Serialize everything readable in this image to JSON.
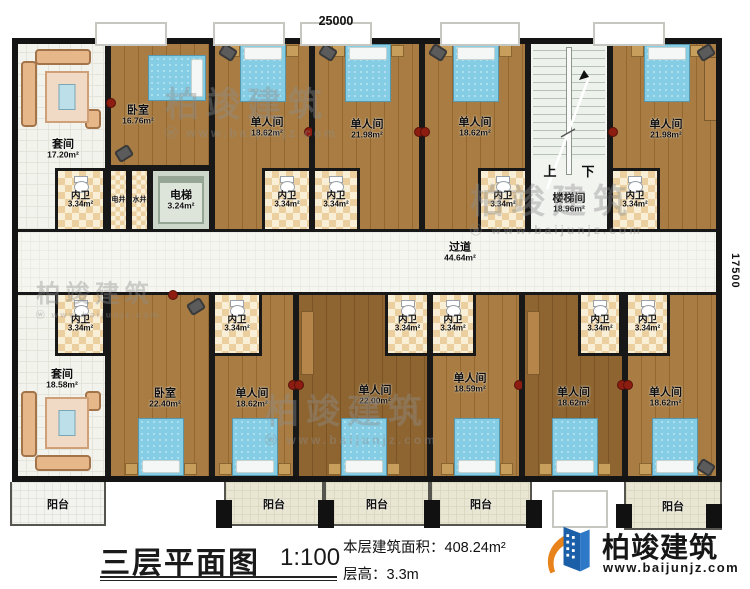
{
  "dimensions": {
    "top": "25000",
    "right": "17500"
  },
  "title_block": {
    "plan_title": "三层平面图",
    "scale": "1:100",
    "area_label": "本层建筑面积：",
    "area_value": "408.24m²",
    "floor_height_label": "层高：",
    "floor_height_value": "3.3m"
  },
  "logo": {
    "name": "柏竣建筑",
    "url": "www.baijunjz.com"
  },
  "watermark": {
    "text": "柏竣建筑",
    "url": "www.baijunjz.com"
  },
  "plan": {
    "stair": {
      "up": "上",
      "down": "下"
    },
    "rooms": [
      {
        "id": "suite-up",
        "name": "套间",
        "area": "17.20m²",
        "x": 12,
        "y": 38,
        "w": 96,
        "h": 194,
        "type": "tile",
        "lx": 3,
        "ly": 14,
        "furn": [
          "sofa-n"
        ]
      },
      {
        "id": "bedroom-up",
        "name": "卧室",
        "area": "16.76m²",
        "x": 108,
        "y": 38,
        "w": 104,
        "h": 130,
        "type": "wood",
        "lx": -22,
        "ly": 12,
        "furn": [
          "bed-e",
          "dot-w",
          "chair-sw"
        ]
      },
      {
        "id": "single-u1",
        "name": "单人间",
        "area": "18.62m²",
        "x": 212,
        "y": 38,
        "w": 100,
        "h": 194,
        "type": "wood",
        "lx": 5,
        "ly": -8,
        "furn": [
          "bed-n",
          "chair-nw",
          "dot-e"
        ]
      },
      {
        "id": "single-u2",
        "name": "单人间",
        "area": "21.98m²",
        "x": 312,
        "y": 38,
        "w": 110,
        "h": 194,
        "type": "wood",
        "lx": 0,
        "ly": -6,
        "furn": [
          "bed-n",
          "chair-nw",
          "dot-e"
        ]
      },
      {
        "id": "single-u3",
        "name": "单人间",
        "area": "18.62m²",
        "x": 422,
        "y": 38,
        "w": 106,
        "h": 194,
        "type": "wood",
        "lx": 0,
        "ly": -8,
        "furn": [
          "bed-n",
          "chair-nw",
          "dot-w"
        ]
      },
      {
        "id": "stairwell",
        "name": "楼梯间",
        "area": "18.96m²",
        "x": 528,
        "y": 38,
        "w": 82,
        "h": 194,
        "type": "stair",
        "lx": 0,
        "ly": 68
      },
      {
        "id": "single-u4",
        "name": "单人间",
        "area": "21.98m²",
        "x": 610,
        "y": 38,
        "w": 112,
        "h": 194,
        "type": "wood",
        "lx": 0,
        "ly": -6,
        "furn": [
          "bed-n",
          "chair-ne",
          "dot-w",
          "desk-e"
        ]
      },
      {
        "id": "bath-u1",
        "name": "内卫",
        "area": "3.34m²",
        "x": 55,
        "y": 168,
        "w": 51,
        "h": 64,
        "type": "bath"
      },
      {
        "id": "shaft-elec",
        "name": "电井",
        "x": 108,
        "y": 168,
        "w": 21,
        "h": 64,
        "type": "shaft"
      },
      {
        "id": "shaft-water",
        "name": "水井",
        "x": 129,
        "y": 168,
        "w": 21,
        "h": 64,
        "type": "shaft"
      },
      {
        "id": "elevator",
        "name": "电梯",
        "area": "3.24m²",
        "x": 150,
        "y": 168,
        "w": 62,
        "h": 64,
        "type": "elevator"
      },
      {
        "id": "bath-u2",
        "name": "内卫",
        "area": "3.34m²",
        "x": 262,
        "y": 168,
        "w": 50,
        "h": 64,
        "type": "bath"
      },
      {
        "id": "bath-u3",
        "name": "内卫",
        "area": "3.34m²",
        "x": 312,
        "y": 168,
        "w": 48,
        "h": 64,
        "type": "bath"
      },
      {
        "id": "bath-u4",
        "name": "内卫",
        "area": "3.34m²",
        "x": 478,
        "y": 168,
        "w": 50,
        "h": 64,
        "type": "bath"
      },
      {
        "id": "bath-u5",
        "name": "内卫",
        "area": "3.34m²",
        "x": 610,
        "y": 168,
        "w": 50,
        "h": 64,
        "type": "bath"
      },
      {
        "id": "corridor",
        "name": "过道",
        "area": "44.64m²",
        "x": 12,
        "y": 232,
        "w": 710,
        "h": 60,
        "type": "corridor",
        "lx": 93,
        "ly": -10
      },
      {
        "id": "suite-low",
        "name": "套间",
        "area": "18.58m²",
        "x": 12,
        "y": 292,
        "w": 96,
        "h": 190,
        "type": "tile",
        "lx": 2,
        "ly": -8,
        "furn": [
          "sofa-s"
        ]
      },
      {
        "id": "bedroom-low",
        "name": "卧室",
        "area": "22.40m²",
        "x": 108,
        "y": 292,
        "w": 104,
        "h": 190,
        "type": "wood",
        "lx": 5,
        "ly": 11,
        "furn": [
          "bed-s",
          "chair-ne",
          "dot-n"
        ]
      },
      {
        "id": "single-l1",
        "name": "单人间",
        "area": "18.62m²",
        "x": 212,
        "y": 292,
        "w": 84,
        "h": 190,
        "type": "wood",
        "lx": -2,
        "ly": 11,
        "furn": [
          "bed-s",
          "dot-e"
        ]
      },
      {
        "id": "single-l2",
        "name": "单人间",
        "area": "22.00m²",
        "x": 296,
        "y": 292,
        "w": 134,
        "h": 190,
        "type": "wood",
        "lx": 12,
        "ly": 8,
        "shade": "dark",
        "furn": [
          "bed-s",
          "dot-w",
          "desk-w"
        ]
      },
      {
        "id": "single-l3",
        "name": "单人间",
        "area": "18.59m²",
        "x": 430,
        "y": 292,
        "w": 92,
        "h": 190,
        "type": "wood",
        "lx": -6,
        "ly": -4,
        "furn": [
          "bed-s",
          "dot-e"
        ]
      },
      {
        "id": "single-l4",
        "name": "单人间",
        "area": "18.62m²",
        "x": 522,
        "y": 292,
        "w": 103,
        "h": 190,
        "type": "wood",
        "lx": 0,
        "ly": 10,
        "shade": "dark",
        "furn": [
          "bed-s",
          "dot-e",
          "desk-w"
        ]
      },
      {
        "id": "single-l5",
        "name": "单人间",
        "area": "18.62m²",
        "x": 625,
        "y": 292,
        "w": 97,
        "h": 190,
        "type": "wood",
        "lx": -8,
        "ly": 10,
        "furn": [
          "bed-s",
          "chair-se",
          "dot-w"
        ]
      },
      {
        "id": "bath-l1",
        "name": "内卫",
        "area": "3.34m²",
        "x": 55,
        "y": 292,
        "w": 51,
        "h": 64,
        "type": "bath"
      },
      {
        "id": "bath-l2",
        "name": "内卫",
        "area": "3.34m²",
        "x": 212,
        "y": 292,
        "w": 50,
        "h": 64,
        "type": "bath"
      },
      {
        "id": "bath-l3",
        "name": "内卫",
        "area": "3.34m²",
        "x": 385,
        "y": 292,
        "w": 45,
        "h": 64,
        "type": "bath"
      },
      {
        "id": "bath-l4",
        "name": "内卫",
        "area": "3.34m²",
        "x": 430,
        "y": 292,
        "w": 46,
        "h": 64,
        "type": "bath"
      },
      {
        "id": "bath-l5",
        "name": "内卫",
        "area": "3.34m²",
        "x": 578,
        "y": 292,
        "w": 44,
        "h": 64,
        "type": "bath"
      },
      {
        "id": "bath-l6",
        "name": "内卫",
        "area": "3.34m²",
        "x": 625,
        "y": 292,
        "w": 45,
        "h": 64,
        "type": "bath"
      }
    ],
    "balconies": [
      {
        "name": "阳台",
        "x": 10,
        "y": 482,
        "w": 96,
        "h": 44,
        "white": true
      },
      {
        "name": "阳台",
        "x": 224,
        "y": 482,
        "w": 100,
        "h": 44
      },
      {
        "name": "阳台",
        "x": 324,
        "y": 482,
        "w": 106,
        "h": 44
      },
      {
        "name": "阳台",
        "x": 430,
        "y": 482,
        "w": 102,
        "h": 44
      },
      {
        "name": "阳台",
        "x": 624,
        "y": 482,
        "w": 98,
        "h": 48
      }
    ]
  },
  "decor": {
    "windows_top": [
      {
        "x": 95,
        "w": 72
      },
      {
        "x": 213,
        "w": 72
      },
      {
        "x": 300,
        "w": 72
      },
      {
        "x": 440,
        "w": 80
      },
      {
        "x": 593,
        "w": 72
      }
    ],
    "pillars": [
      {
        "x": 216,
        "y": 500,
        "h": 28
      },
      {
        "x": 318,
        "y": 500,
        "h": 28
      },
      {
        "x": 424,
        "y": 500,
        "h": 28
      },
      {
        "x": 526,
        "y": 500,
        "h": 28
      },
      {
        "x": 616,
        "y": 504,
        "h": 24
      },
      {
        "x": 706,
        "y": 504,
        "h": 24
      }
    ],
    "bottom_window": {
      "x": 552,
      "y": 490,
      "w": 56,
      "h": 38
    },
    "watermarks": [
      {
        "x": 165,
        "y": 88
      },
      {
        "x": 470,
        "y": 185
      },
      {
        "x": 265,
        "y": 395
      },
      {
        "x": 36,
        "y": 282,
        "small": true
      }
    ]
  }
}
